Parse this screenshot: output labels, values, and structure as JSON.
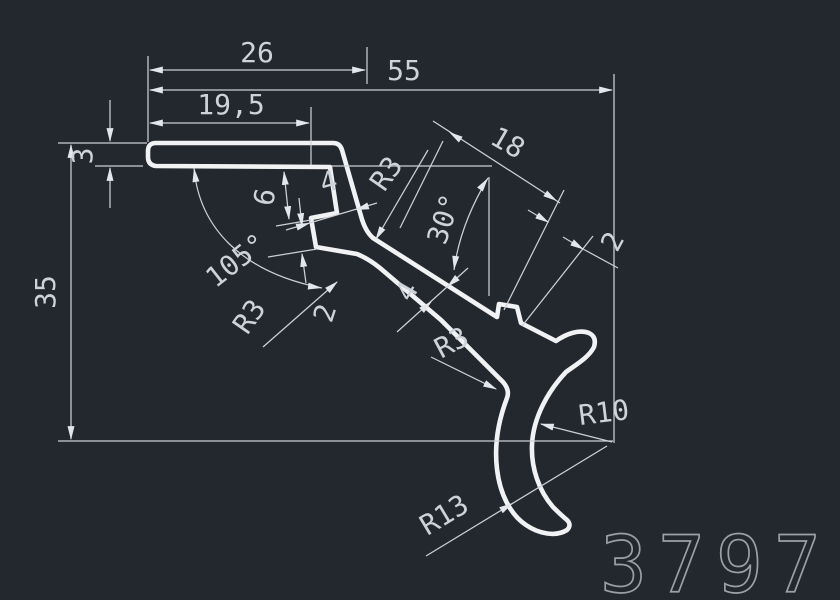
{
  "drawing": {
    "type": "cad-profile-cross-section",
    "part_number": "3797",
    "colors": {
      "background": "#23272e",
      "profile_line": "#f1f2f4",
      "dimension_line": "#ccd0d6",
      "dimension_text": "#ced3d9",
      "part_number_stroke": "#9aa0a7"
    },
    "dims": {
      "width_top": "26",
      "width_total": "55",
      "width_flange": "19,5",
      "flange_thickness": "3",
      "height_total": "35",
      "flange_angle": "105°",
      "slot_offset": "6",
      "leg_thickness_upper": "4",
      "fillet_upper": "R3",
      "notch_step": "2",
      "fillet_notch": "R3",
      "leg_angle": "30°",
      "leg_length": "18",
      "lip_height": "2",
      "leg_thickness_lower": "4",
      "fillet_lower": "R3",
      "radius_outer": "R10",
      "radius_inner": "R13"
    }
  }
}
